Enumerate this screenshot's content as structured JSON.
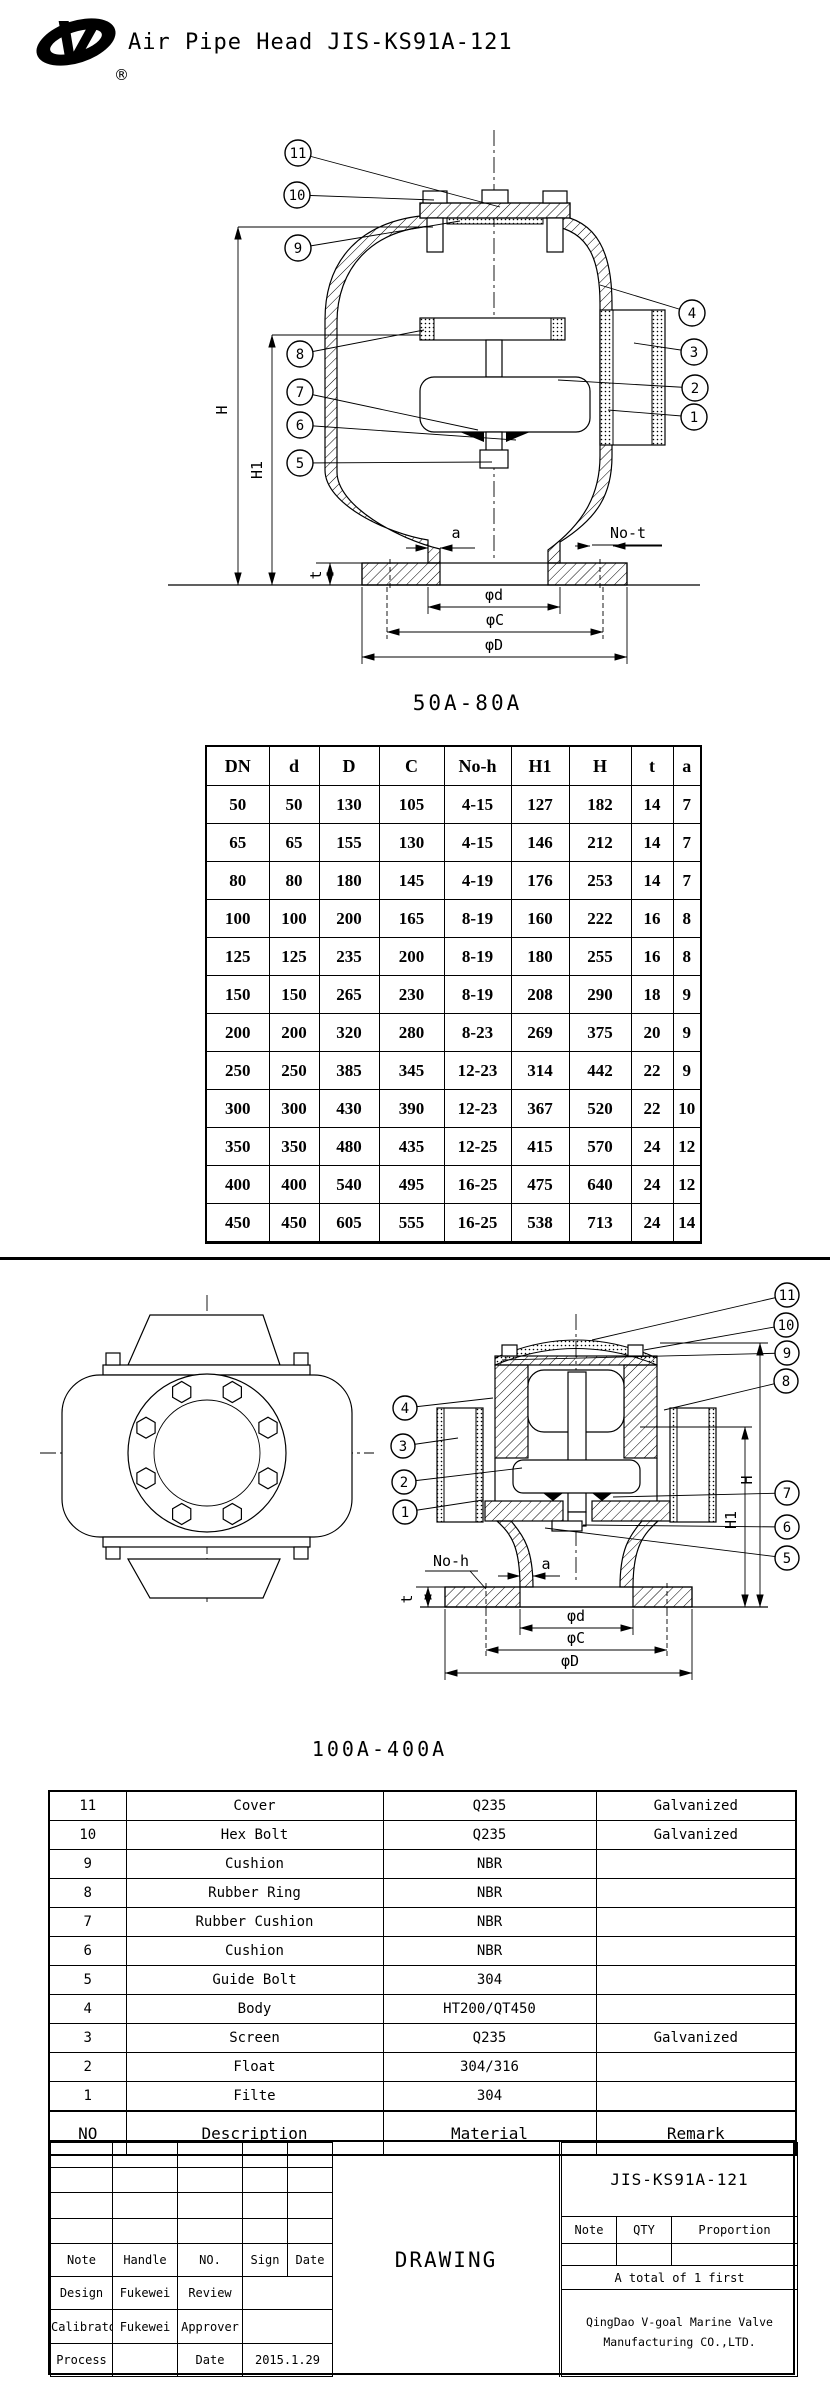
{
  "colors": {
    "ink": "#000000",
    "paper": "#ffffff"
  },
  "header": {
    "title": "Air Pipe Head JIS-KS91A-121",
    "registered": "®"
  },
  "drawing1": {
    "caption": "50A-80A",
    "callouts": [
      "11",
      "10",
      "9",
      "8",
      "7",
      "6",
      "5",
      "4",
      "3",
      "2",
      "1"
    ],
    "dims": {
      "H": "H",
      "H1": "H1",
      "a": "a",
      "no_t": "No-t",
      "t": "t",
      "phi_d": "φd",
      "phi_c": "φC",
      "phi_D": "φD"
    }
  },
  "dim_table": {
    "headers": [
      "DN",
      "d",
      "D",
      "C",
      "No-h",
      "H1",
      "H",
      "t",
      "a"
    ],
    "rows": [
      [
        "50",
        "50",
        "130",
        "105",
        "4-15",
        "127",
        "182",
        "14",
        "7"
      ],
      [
        "65",
        "65",
        "155",
        "130",
        "4-15",
        "146",
        "212",
        "14",
        "7"
      ],
      [
        "80",
        "80",
        "180",
        "145",
        "4-19",
        "176",
        "253",
        "14",
        "7"
      ],
      [
        "100",
        "100",
        "200",
        "165",
        "8-19",
        "160",
        "222",
        "16",
        "8"
      ],
      [
        "125",
        "125",
        "235",
        "200",
        "8-19",
        "180",
        "255",
        "16",
        "8"
      ],
      [
        "150",
        "150",
        "265",
        "230",
        "8-19",
        "208",
        "290",
        "18",
        "9"
      ],
      [
        "200",
        "200",
        "320",
        "280",
        "8-23",
        "269",
        "375",
        "20",
        "9"
      ],
      [
        "250",
        "250",
        "385",
        "345",
        "12-23",
        "314",
        "442",
        "22",
        "9"
      ],
      [
        "300",
        "300",
        "430",
        "390",
        "12-23",
        "367",
        "520",
        "22",
        "10"
      ],
      [
        "350",
        "350",
        "480",
        "435",
        "12-25",
        "415",
        "570",
        "24",
        "12"
      ],
      [
        "400",
        "400",
        "540",
        "495",
        "16-25",
        "475",
        "640",
        "24",
        "12"
      ],
      [
        "450",
        "450",
        "605",
        "555",
        "16-25",
        "538",
        "713",
        "24",
        "14"
      ]
    ]
  },
  "drawing2": {
    "caption": "100A-400A",
    "callouts": [
      "4",
      "3",
      "2",
      "1",
      "11",
      "10",
      "9",
      "8",
      "7",
      "6",
      "5"
    ],
    "dims": {
      "H": "H",
      "H1": "H1",
      "a": "a",
      "no_h": "No-h",
      "t": "t",
      "phi_d": "φd",
      "phi_c": "φC",
      "phi_D": "φD"
    }
  },
  "parts_table": {
    "rows": [
      [
        "11",
        "Cover",
        "Q235",
        "Galvanized"
      ],
      [
        "10",
        "Hex Bolt",
        "Q235",
        "Galvanized"
      ],
      [
        "9",
        "Cushion",
        "NBR",
        ""
      ],
      [
        "8",
        "Rubber Ring",
        "NBR",
        ""
      ],
      [
        "7",
        "Rubber Cushion",
        "NBR",
        ""
      ],
      [
        "6",
        "Cushion",
        "NBR",
        ""
      ],
      [
        "5",
        "Guide Bolt",
        "304",
        ""
      ],
      [
        "4",
        "Body",
        "HT200/QT450",
        ""
      ],
      [
        "3",
        "Screen",
        "Q235",
        "Galvanized"
      ],
      [
        "2",
        "Float",
        "304/316",
        ""
      ],
      [
        "1",
        "Filte",
        "304",
        ""
      ]
    ],
    "footer_headers": [
      "NO",
      "Description",
      "Material",
      "Remark"
    ]
  },
  "title_block": {
    "drawing_no": "JIS-KS91A-121",
    "col_headers": [
      "Note",
      "Handle",
      "NO.",
      "Sign",
      "Date"
    ],
    "design_label": "Design",
    "design_value": "Fukewei",
    "review_label": "Review",
    "calibrator_label": "Calibrator",
    "calibrator_value": "Fukewei",
    "approver_label": "Approver",
    "process_label": "Process",
    "date_label": "Date",
    "date_value": "2015.1.29",
    "center_label": "DRAWING",
    "right_headers": [
      "Note",
      "QTY",
      "Proportion"
    ],
    "total_note": "A total of 1 first",
    "company_line1": "QingDao V-goal Marine Valve",
    "company_line2": "Manufacturing CO.,LTD."
  }
}
